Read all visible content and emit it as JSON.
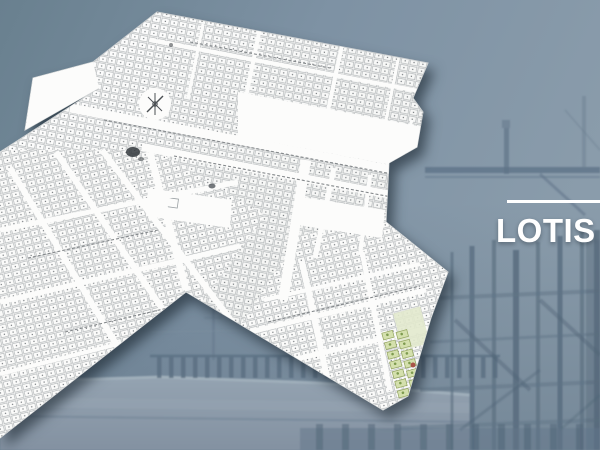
{
  "title": {
    "label": "LOTIS"
  },
  "accents": {
    "title_color": "#ffffff",
    "rule_color": "#ffffff"
  },
  "background": {
    "scene": "construction-site-photograph",
    "sky_color": "#7e92a4",
    "steel_color": "#5e7284",
    "deck_color": "#8d9cab"
  },
  "map": {
    "name": "lotissement-parcel-plan",
    "paper_color": "#fbfbfa",
    "parcel_line_color": "#b2b6b8",
    "green_parcel_fill": "#d4e0ad",
    "green_parcel_stroke": "#93a45f",
    "red_mark_color": "#a85548",
    "features": [
      "parcel-grid",
      "street-network",
      "compass-rose",
      "green-parcel-strip",
      "ink-smudges"
    ]
  }
}
